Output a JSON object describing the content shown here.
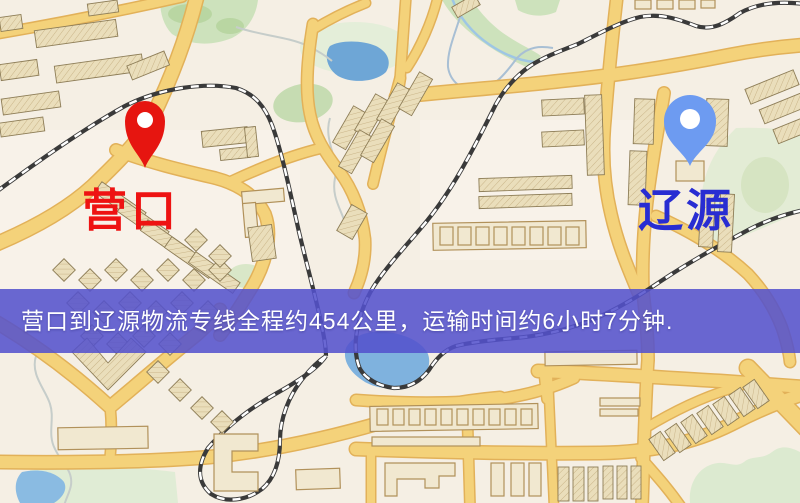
{
  "banner": {
    "text": "营口到辽源物流专线全程约454公里，运输时间约6小时7分钟.",
    "bg_color": "#5451cd",
    "text_color": "#ffffff"
  },
  "markers": {
    "origin": {
      "label": "营口",
      "label_color": "#ee1312",
      "pin_color": "#e61510"
    },
    "destination": {
      "label": "辽源",
      "label_color": "#282dd2",
      "pin_color": "#6d9bf1"
    }
  },
  "map_colors": {
    "base": "#f5efe4",
    "road_fill": "#f4d27a",
    "road_edge": "#e2b159",
    "railway": "#3a3a3a",
    "water": "#7fb2de",
    "park_green": "#d8e7c6",
    "building": "#eadebb"
  }
}
